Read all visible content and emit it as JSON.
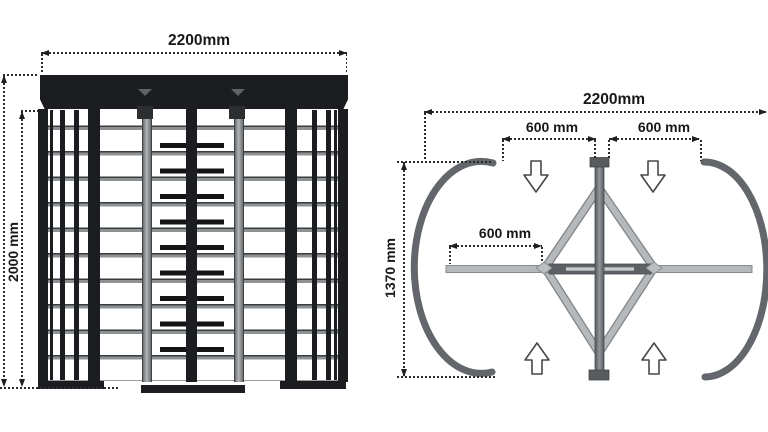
{
  "diagram": {
    "subject": "double full-height turnstile dimension drawing",
    "front_view": {
      "width_label": "2200mm",
      "height_label": "2000 mm"
    },
    "plan_view": {
      "overall_width_label": "2200mm",
      "left_passage_label": "600 mm",
      "right_passage_label": "600 mm",
      "wing_length_label": "600 mm",
      "depth_label": "1370 mm"
    },
    "icons": {
      "flow_top": "down-arrow-icon",
      "flow_bottom": "up-arrow-icon",
      "canopy_marks": "chevron-down-icon"
    },
    "colors": {
      "structure_black": "#1b1d20",
      "rail_gray": "#8f9295",
      "rotor_gray": "#b2b5b8",
      "plan_light_bar": "#b6b9bc",
      "plan_dark_bar": "#5d6165",
      "guide_arc": "#63666a",
      "dimension_line": "#2b2b2b",
      "background": "#ffffff"
    }
  }
}
